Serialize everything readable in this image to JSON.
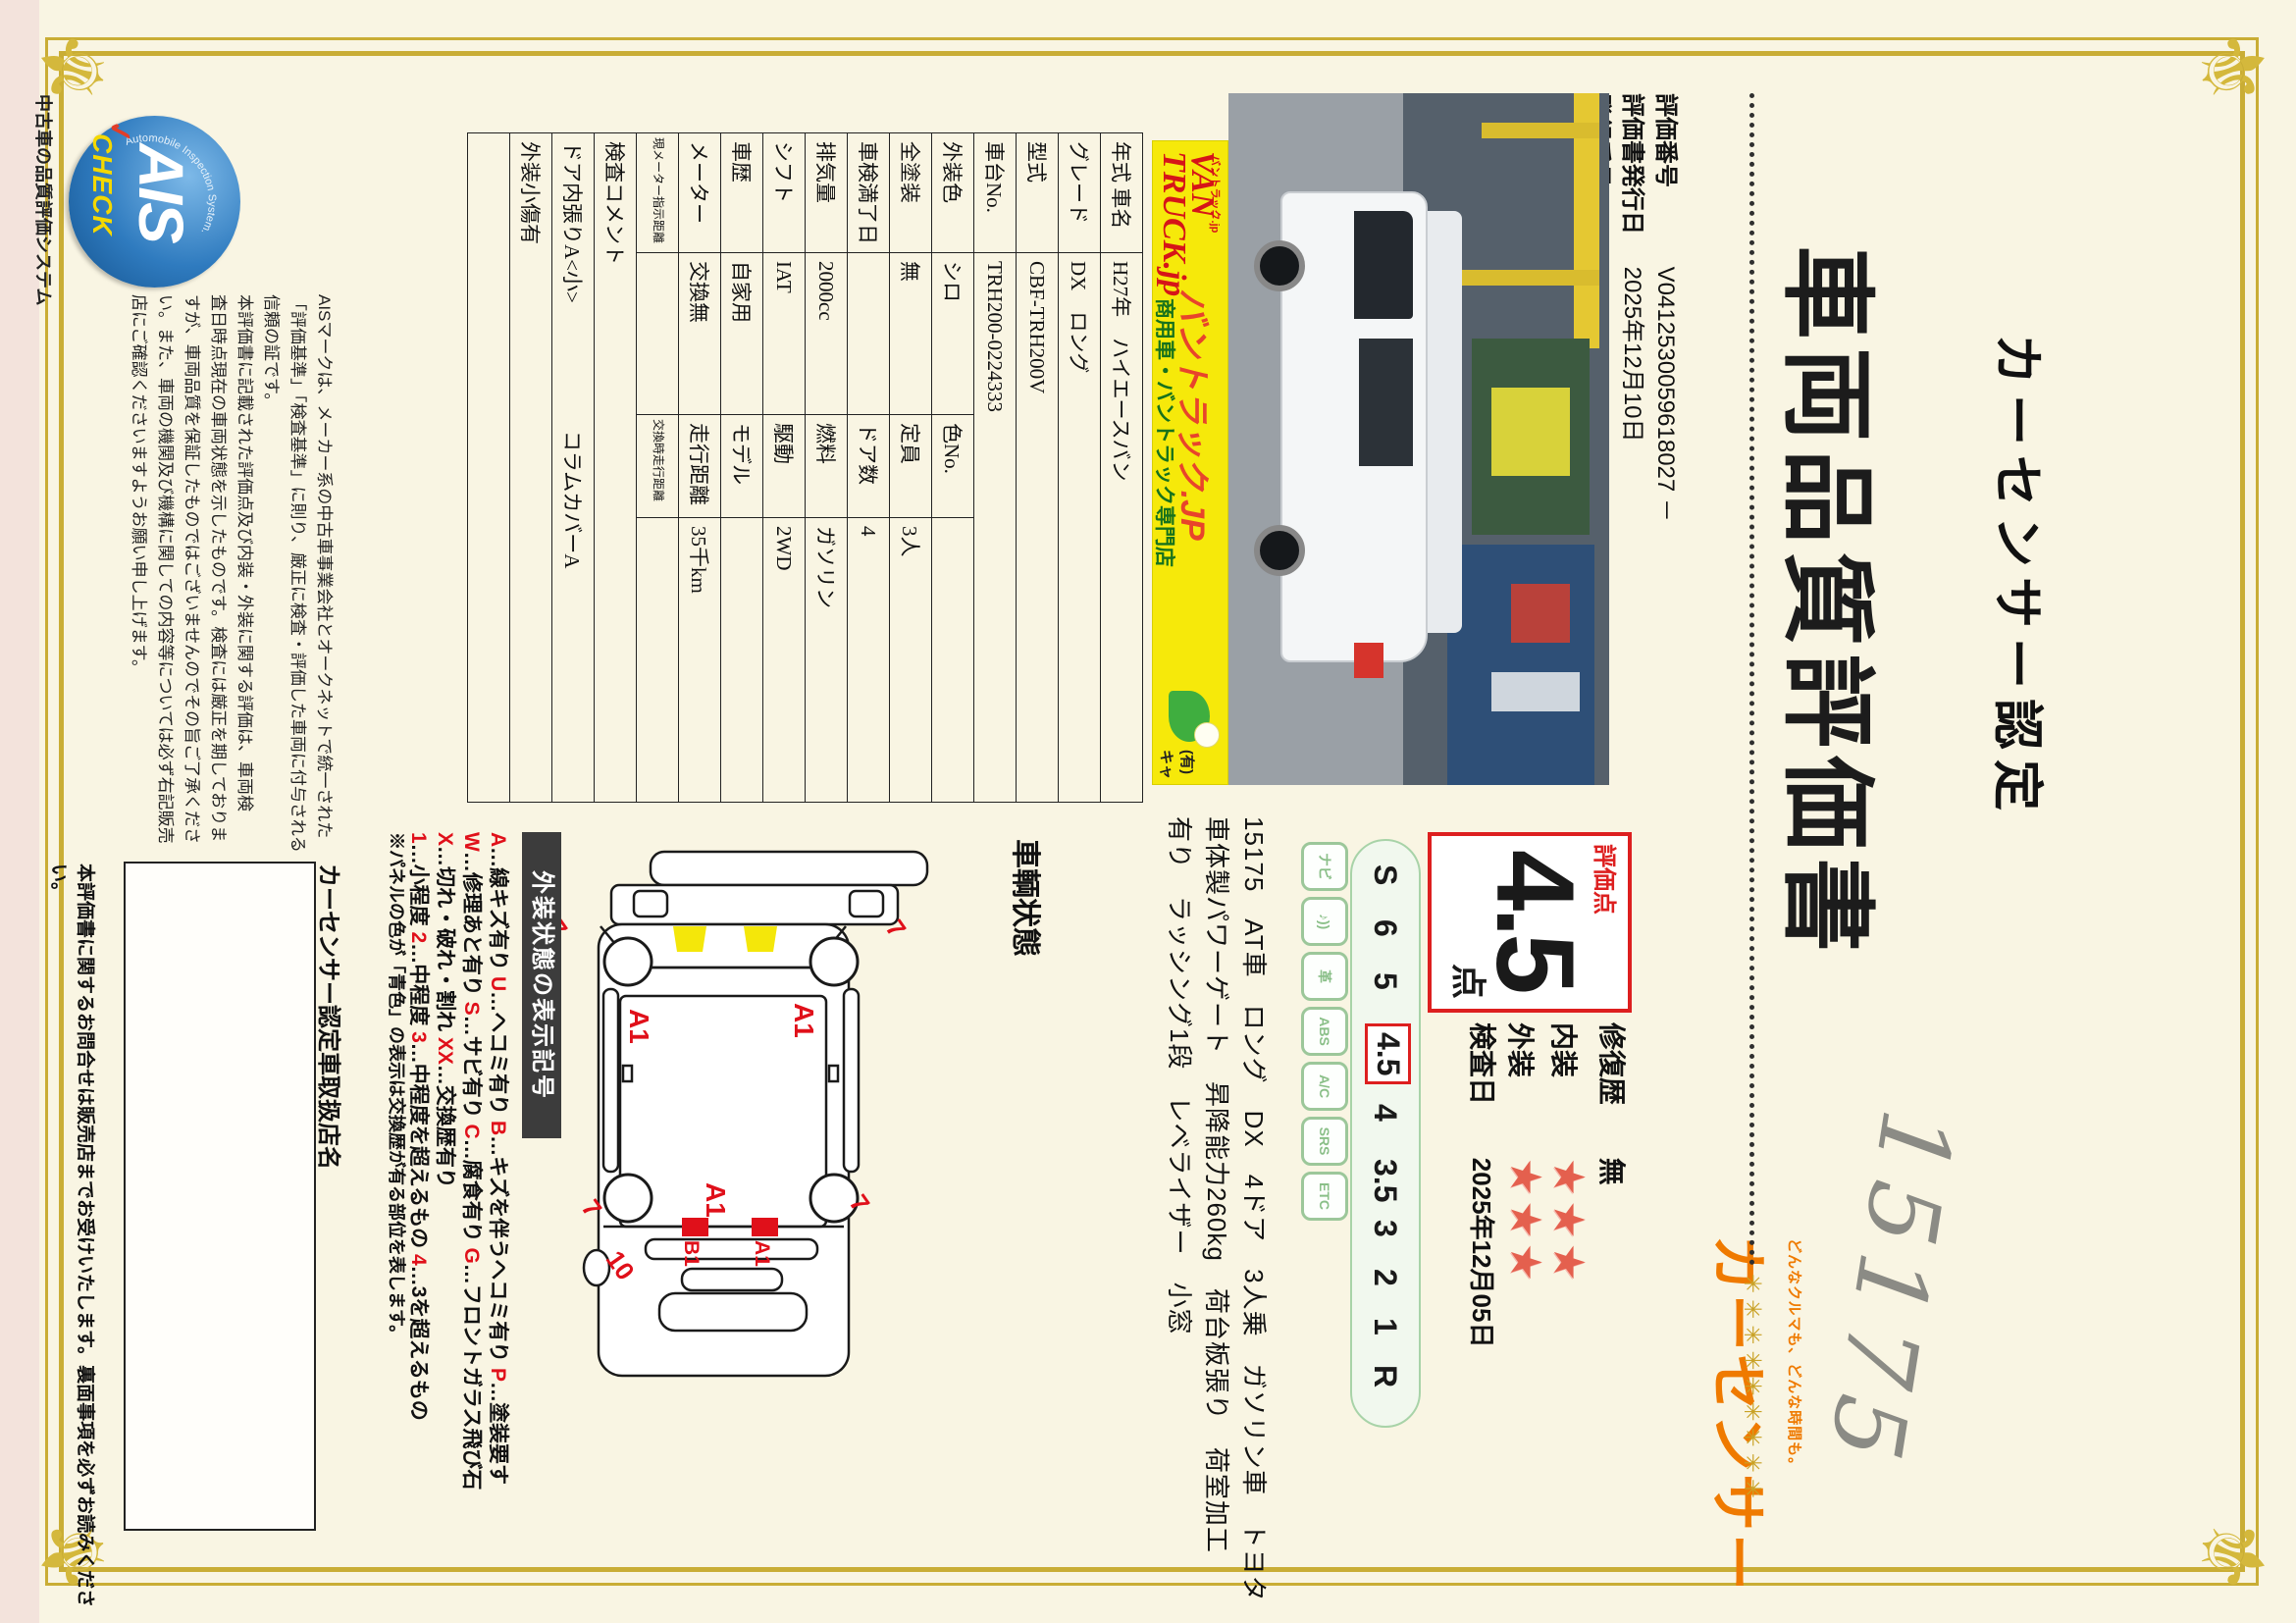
{
  "header": {
    "cert_label": "カーセンサー認定",
    "title": "車両品質評価書",
    "eval_no_label": "評価番号",
    "eval_no": "V0412530059618027 －",
    "issue_label": "評価書発行日",
    "issue_date": "2025年12月10日",
    "reg_label": "登録番号",
    "reg_no": "V33600113 S001464147",
    "handwritten_number": "15175",
    "stars_decoration": "✳✳✳✳✳✳✳✳✳",
    "logo_slogan": "どんなクルマも、どんな時間も。",
    "logo_name": "カーセンサー"
  },
  "banner": {
    "small_top": "バントラック.jp",
    "van": "VAN",
    "truck": "TRUCK.jp",
    "katakana": "バントラック.JP",
    "subtitle": "商用車・バントラック専門店",
    "company": "(有)キャン"
  },
  "spec_table": {
    "rows": [
      {
        "label": "年式 車名",
        "value": "H27年　ハイエースバン",
        "full": true
      },
      {
        "label": "グレード",
        "value": "DX　ロング",
        "full": true
      },
      {
        "label": "型式",
        "value": "CBF-TRH200V",
        "full": true
      },
      {
        "label": "車台No.",
        "value": "TRH200-0224333",
        "full": true
      },
      {
        "label": "外装色",
        "value": "シロ",
        "label2": "色No.",
        "value2": ""
      },
      {
        "label": "全塗装",
        "value": "無",
        "label2": "定員",
        "value2": "3人"
      },
      {
        "label": "車検満了日",
        "value": "",
        "label2": "ドア数",
        "value2": "4"
      },
      {
        "label": "排気量",
        "value": "2000cc",
        "label2": "燃料",
        "value2": "ガソリン"
      },
      {
        "label": "シフト",
        "value": "IAT",
        "label2": "駆動",
        "value2": "2WD"
      },
      {
        "label": "車歴",
        "value": "自家用",
        "label2": "モデル",
        "value2": ""
      },
      {
        "label": "メーター",
        "value": "交換無",
        "label2": "走行距離",
        "value2": "35千km"
      },
      {
        "label": "現メーター指示距離",
        "value": "",
        "label2": "交換時走行距離",
        "value2": "",
        "small": true
      }
    ],
    "comment_label": "検査コメント",
    "comment_line1a": "ドア内張りA<小>",
    "comment_line1b": "コラムカバーA",
    "comment_line2": "外装小傷有"
  },
  "rating": {
    "box_label": "評価点",
    "score": "4.5",
    "unit": "点",
    "scale": [
      "S",
      "6",
      "5",
      "4.5",
      "4",
      "3.5",
      "3",
      "2",
      "1",
      "R"
    ],
    "selected": "4.5"
  },
  "equipment": {
    "icons": [
      {
        "name": "navi-icon",
        "glyph": "ナビ"
      },
      {
        "name": "audio-icon",
        "glyph": "♪))"
      },
      {
        "name": "leather-seat-icon",
        "glyph": "革"
      },
      {
        "name": "abs-icon",
        "glyph": "ABS"
      },
      {
        "name": "ac-icon",
        "glyph": "A/C"
      },
      {
        "name": "airbag-icon",
        "glyph": "SRS"
      },
      {
        "name": "etc-icon",
        "glyph": "ETC"
      }
    ],
    "lines": [
      "15175　AT車　ロング　DX　4ドア　3人乗　ガソリン車　トヨタ",
      "車体製パワーゲート　昇降能力260kg　荷台板張り　荷室加工",
      "有り　ラッシング1段　レベライザー　小窓"
    ]
  },
  "condition": {
    "repair_label": "修復歴",
    "repair_value": "無",
    "interior_label": "内装",
    "interior_stars": 3,
    "exterior_label": "外装",
    "exterior_stars": 3,
    "inspection_label": "検査日",
    "inspection_date": "2025年12月05日"
  },
  "diagram": {
    "label": "車輌状態",
    "mark_side_top": "A1",
    "mark_side_bottom": "A1",
    "mark_rear_center": "A1",
    "mark_rear_upper": "A1",
    "mark_rear_lower": "B1",
    "corner_front_top": "7",
    "corner_rear_top": "7",
    "corner_front_bottom": "7",
    "corner_rear_bottom": "7",
    "mark_rear_ten": "10"
  },
  "legend": {
    "header": "外装状態の表示記号",
    "rows": [
      [
        [
          "A",
          "…線キズ有り "
        ],
        [
          "U",
          "…ヘコミ有り "
        ],
        [
          "B",
          "…キズを伴うヘコミ有り "
        ],
        [
          "P",
          "…塗装要す"
        ]
      ],
      [
        [
          "W",
          "…修理あと有り "
        ],
        [
          "S",
          "…サビ有り "
        ],
        [
          "C",
          "…腐食有り "
        ],
        [
          "G",
          "…フロントガラス飛び石"
        ]
      ],
      [
        [
          "X",
          "…切れ・破れ・割れ "
        ],
        [
          "XX",
          "…交換歴有り"
        ]
      ],
      [
        [
          "1",
          "…小程度 "
        ],
        [
          "2",
          "…中程度 "
        ],
        [
          "3",
          "…中程度を超えるもの "
        ],
        [
          "4",
          "…3を超えるもの"
        ]
      ]
    ],
    "note": "※パネルの色が「青色」の表示は交換歴が有る部位を表します。"
  },
  "footer": {
    "ais_name": "AIS",
    "ais_arc": "Automobile Inspection System.",
    "ais_check": "CHECK",
    "ais_tick": "✓",
    "ais_caption": "中古車の品質評価システム",
    "disclaimer": [
      "AISマークは、メーカー系の中古車事業会社とオークネットで統一された",
      "「評価基準」「検査基準」に則り、厳正に検査・評価した車両に付与される",
      "信頼の証です。",
      "本評価書に記載された評価点及び内装・外装に関する評価は、車両検",
      "査日時点現在の車両状態を示したものです。検査には厳正を期しておりま",
      "すが、車両品質を保証したものではございませんのでその旨ご了承くださ",
      "い。また、車両の機関及び機構に関しての内容等については必ず右記販売",
      "店にご確認くださいますようお願い申し上げます。"
    ],
    "dealer_label": "カーセンサー認定車取扱店名",
    "bottom_note": "本評価書に関するお問合せは販売店までお受けいたします。裏面事項を必ずお読みください。"
  }
}
